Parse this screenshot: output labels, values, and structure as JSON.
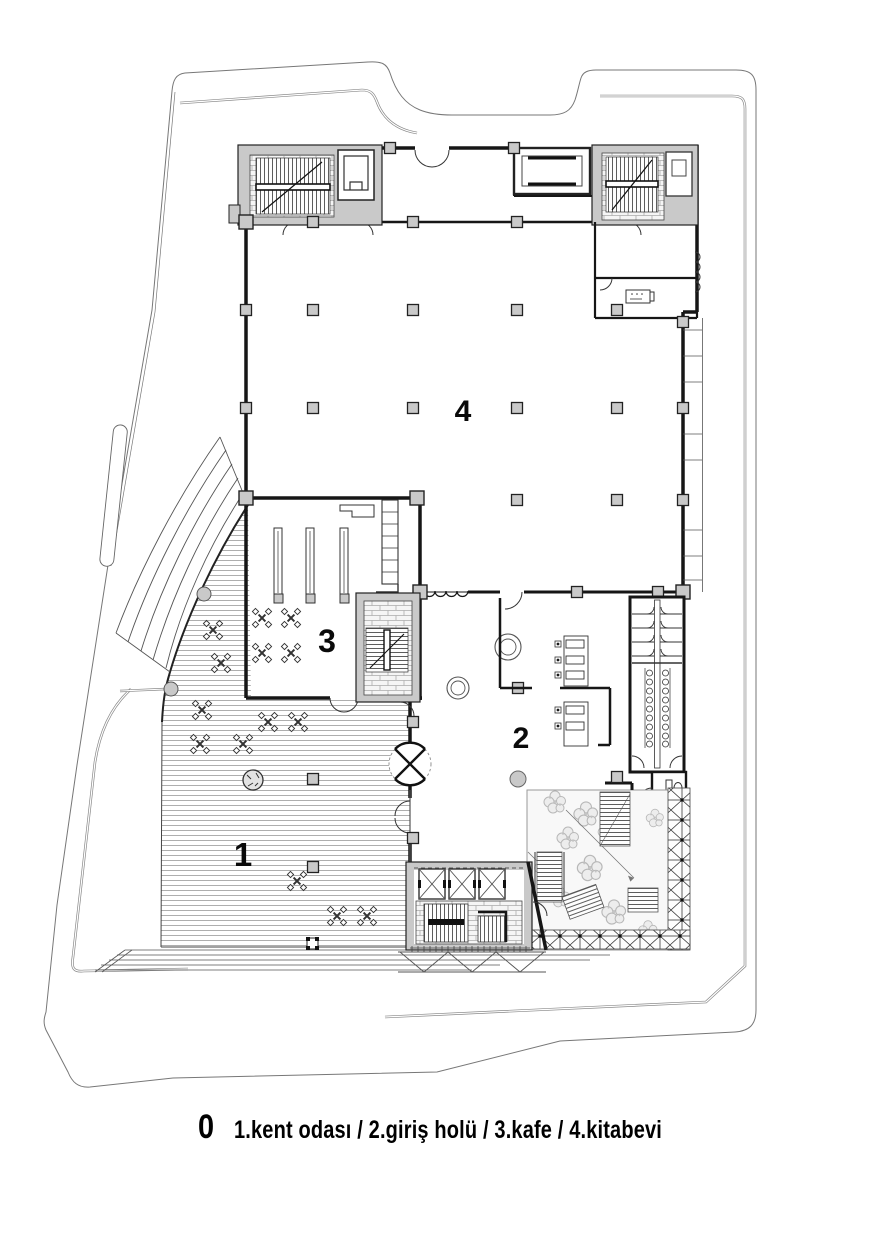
{
  "plan": {
    "drawing_type": "architectural floor plan",
    "floor_number": "0",
    "legend": "1.kent odası / 2.giriş holü / 3.kafe / 4.kitabevi",
    "rooms": [
      {
        "number": "1",
        "name": "kent odası"
      },
      {
        "number": "2",
        "name": "giriş holü"
      },
      {
        "number": "3",
        "name": "kafe"
      },
      {
        "number": "4",
        "name": "kitabevi"
      }
    ],
    "colors": {
      "paper": "#ffffff",
      "wall": "#161616",
      "concrete_fill": "#c9c9c9",
      "light_line": "#8a8a8a",
      "deck_stripe": "#9a9a9a",
      "garden_fill": "#f8f8f8",
      "tree_line": "#b8b8b8"
    }
  }
}
